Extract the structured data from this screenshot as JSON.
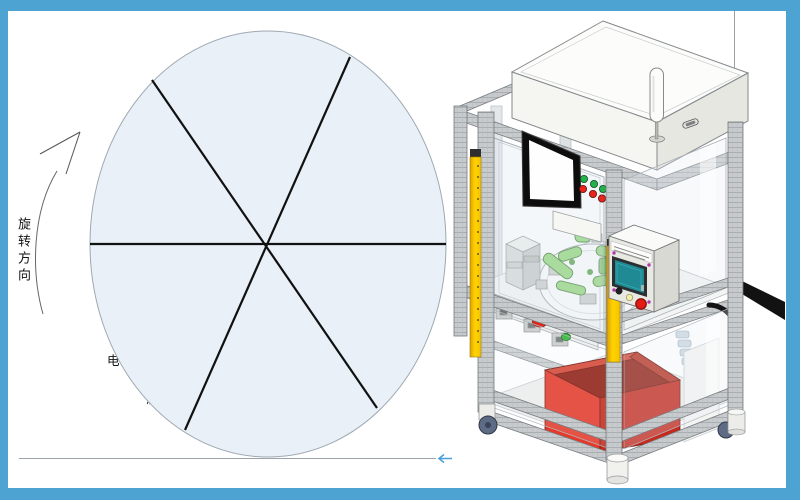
{
  "page": {
    "border_color": "#4da4d2",
    "background": "#ffffff"
  },
  "diagram": {
    "rotation_label": "旋转方向",
    "circle_fill": "#e9f0f8",
    "stations": [
      {
        "num": "1",
        "label": "上料工位"
      },
      {
        "num": "2",
        "label": "电性能测试、阀行程测试",
        "label_line1": "电性能测试、阀行程",
        "label_line2": "测试"
      },
      {
        "num": "3",
        "label": "动作特性及流量"
      },
      {
        "num": "4",
        "label": "密封性能测试"
      },
      {
        "num": "5",
        "label": "备用工位"
      },
      {
        "num": "6",
        "label": "下料及打标"
      }
    ]
  },
  "machine": {
    "colors": {
      "safety_yellow": "#f6c200",
      "bin_red": "#e6392a",
      "pendant_screen_teal": "#1f8a93",
      "indicator_green": "#22b14c",
      "indicator_red": "#e8241c",
      "fixture_green": "#8bd470",
      "frame_gray": "#c7cbcd"
    }
  }
}
